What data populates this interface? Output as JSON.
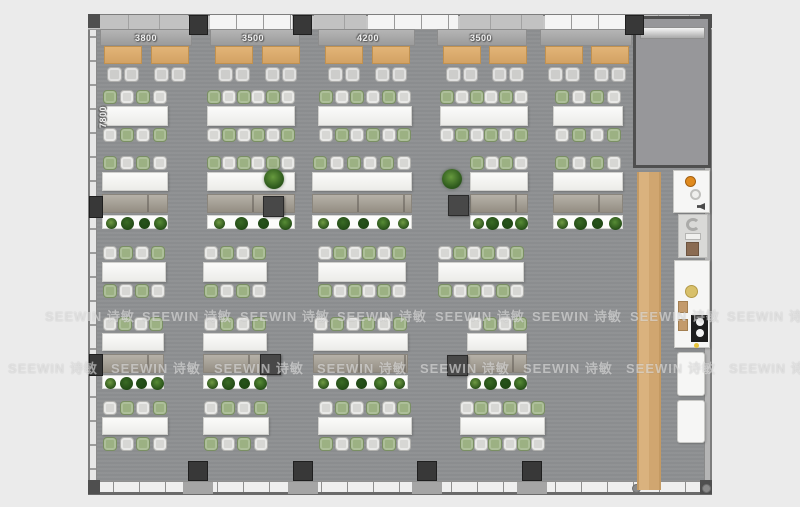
{
  "watermark": {
    "text": "SEEWIN 诗敏"
  },
  "dimensions": {
    "top": [
      {
        "label": "3800",
        "cx": 146
      },
      {
        "label": "3500",
        "cx": 253
      },
      {
        "label": "4200",
        "cx": 368
      },
      {
        "label": "3500",
        "cx": 481
      }
    ],
    "left": {
      "label": "7800",
      "cx": 103,
      "cy": 117
    }
  },
  "palette": {
    "floor": "#8e9092",
    "wall": "#c6c6c6",
    "wood_strip": "#d8ae77",
    "banquette_table": "#ddab6c",
    "chair_green": "#9cb183",
    "chair_gray": "#d7d7d4",
    "desk_white": "#f7f7f5",
    "credenza": "#a29c92",
    "accent_orange": "#e08a1e"
  },
  "floorplan": {
    "banquette": {
      "bench_zones": [
        [
          100,
          92
        ],
        [
          210,
          90
        ],
        [
          318,
          97
        ],
        [
          437,
          90
        ],
        [
          540,
          92
        ]
      ],
      "tables_x": [
        104,
        151,
        215,
        262,
        325,
        372,
        443,
        489,
        545,
        591
      ],
      "table_y": 46,
      "table_w": 38,
      "table_h": 18,
      "chair_y": 67
    },
    "cluster_rows": [
      {
        "name": "row-a",
        "type": "double",
        "y": 106,
        "th": 20,
        "start": "green",
        "items": [
          [
            102,
            66,
            4
          ],
          [
            207,
            88,
            6
          ],
          [
            318,
            94,
            6
          ],
          [
            440,
            88,
            6
          ],
          [
            553,
            70,
            4
          ]
        ]
      },
      {
        "name": "row-b",
        "type": "desk",
        "y": 172,
        "th": 19,
        "start": "green",
        "items": [
          [
            102,
            66,
            4
          ],
          [
            207,
            88,
            6
          ],
          [
            312,
            100,
            6
          ],
          [
            470,
            58,
            4
          ],
          [
            553,
            70,
            4
          ]
        ]
      },
      {
        "name": "row-c",
        "type": "double",
        "y": 262,
        "th": 20,
        "start": "gray",
        "items": [
          [
            102,
            64,
            4
          ],
          [
            203,
            64,
            4
          ],
          [
            318,
            88,
            6
          ],
          [
            438,
            86,
            6
          ]
        ]
      },
      {
        "name": "row-d",
        "type": "desk",
        "y": 333,
        "th": 18,
        "start": "gray",
        "items": [
          [
            102,
            62,
            4
          ],
          [
            203,
            64,
            4
          ],
          [
            313,
            95,
            6
          ],
          [
            467,
            60,
            4
          ]
        ]
      },
      {
        "name": "row-e",
        "type": "double",
        "y": 417,
        "th": 18,
        "start": "gray",
        "items": [
          [
            102,
            66,
            4
          ],
          [
            203,
            66,
            4
          ],
          [
            318,
            94,
            6
          ],
          [
            460,
            85,
            6
          ]
        ]
      }
    ],
    "pillars": {
      "top_x": [
        189,
        293,
        625
      ],
      "bottom_x": [
        188,
        293,
        417,
        522
      ],
      "left_y": [
        196,
        354
      ],
      "interior": [
        [
          263,
          196
        ],
        [
          448,
          195
        ],
        [
          260,
          354
        ],
        [
          447,
          355
        ]
      ]
    },
    "plants_standalone": [
      [
        264,
        169
      ],
      [
        442,
        169
      ]
    ],
    "window_panes": {
      "white": [
        [
          210,
          82
        ],
        [
          368,
          90
        ],
        [
          545,
          81
        ]
      ],
      "gray": [
        [
          98,
          90
        ],
        [
          314,
          52
        ],
        [
          460,
          83
        ],
        [
          628,
          76
        ]
      ]
    },
    "bottom_fills": [
      [
        183,
        30
      ],
      [
        288,
        30
      ],
      [
        412,
        30
      ],
      [
        517,
        30
      ]
    ],
    "watermark_rows": [
      {
        "y": 306,
        "xs": [
          45,
          142,
          240,
          337,
          435,
          532,
          630,
          727
        ]
      },
      {
        "y": 358,
        "xs": [
          8,
          111,
          214,
          317,
          420,
          523,
          626,
          729
        ]
      }
    ],
    "planter_plant_colors": [
      "#6f9b43",
      "#3a6b25",
      "#27541b",
      "#578c35"
    ]
  }
}
